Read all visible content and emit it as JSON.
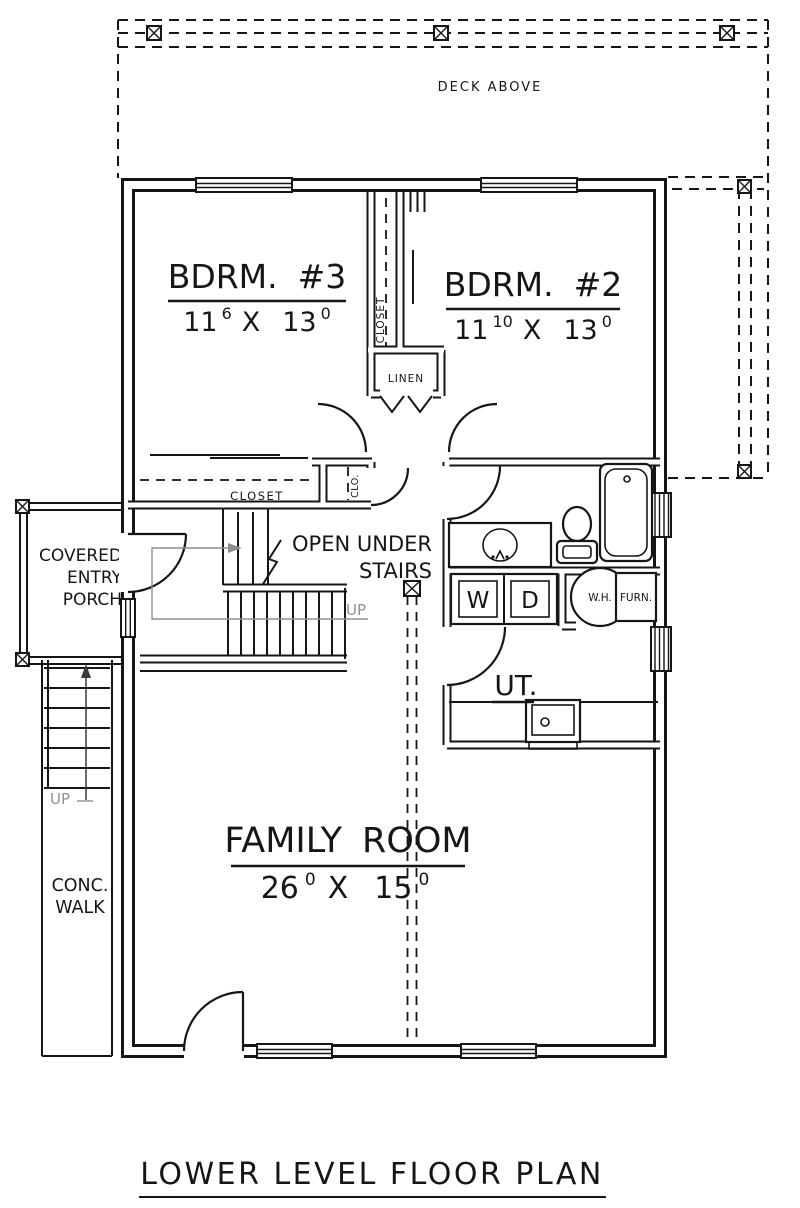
{
  "title": "LOWER LEVEL FLOOR PLAN",
  "deck": {
    "label": "DECK ABOVE"
  },
  "rooms": {
    "bdrm3": {
      "name": "BDRM.",
      "number": "#3",
      "dim": [
        "11",
        "6",
        "X",
        "13",
        "0"
      ]
    },
    "bdrm2": {
      "name": "BDRM.",
      "number": "#2",
      "dim": [
        "11",
        "10",
        "X",
        "13",
        "0"
      ]
    },
    "family_room": {
      "name": "FAMILY",
      "name2": "ROOM",
      "dim": [
        "26",
        "0",
        "X",
        "15",
        "0"
      ]
    },
    "utility": {
      "label": "UT."
    }
  },
  "closets": {
    "bdrm3_closet": "CLOSET",
    "bdrm2_closet": "CLOSET",
    "clo": "CLO.",
    "linen": "LINEN"
  },
  "stairs": {
    "note1": "OPEN UNDER",
    "note2": "STAIRS",
    "up_interior": "UP",
    "up_exterior": "UP"
  },
  "exterior": {
    "porch_line1": "COVERED",
    "porch_line2": "ENTRY",
    "porch_line3": "PORCH",
    "walk_line1": "CONC.",
    "walk_line2": "WALK"
  },
  "equipment": {
    "water_heater": "W.H.",
    "furnace": "FURN.",
    "washer": "W",
    "dryer": "D"
  },
  "colors": {
    "ink": "#161616",
    "paper": "#ffffff",
    "faint": "#909090"
  }
}
